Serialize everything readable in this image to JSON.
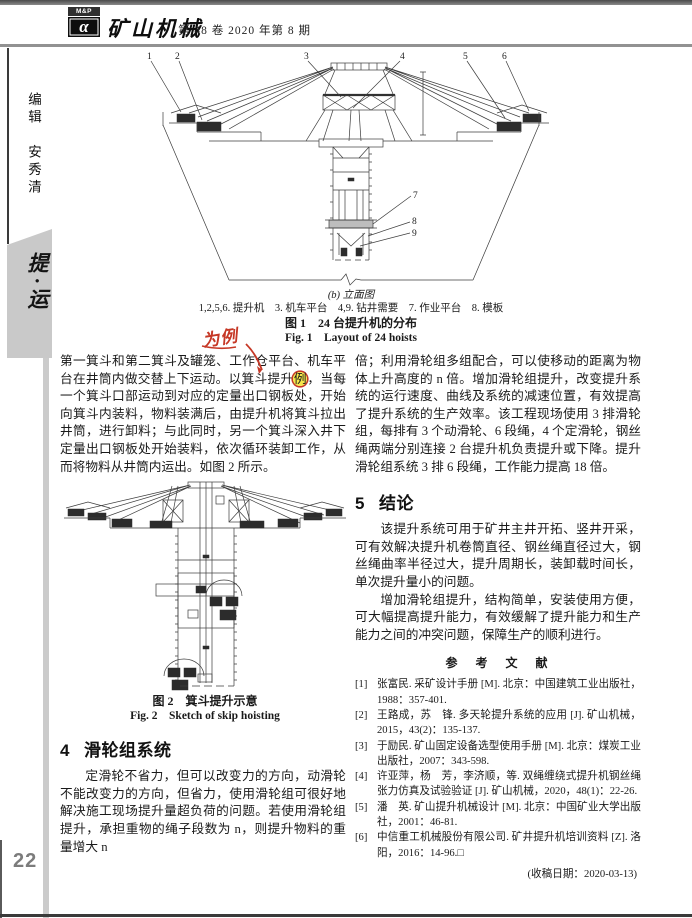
{
  "header": {
    "logo_top": "M&P",
    "logo_alpha": "α",
    "journal_name": "矿山机械",
    "issue_info": "第 48 卷 2020 年第 8 期"
  },
  "sidebar": {
    "editor": "编辑　安秀清",
    "section_tab": "提·运",
    "page_number": "22"
  },
  "figure1": {
    "sublabel": "(b) 立面图",
    "legend": "1,2,5,6. 提升机　3. 机车平台　4,9. 钻井需要　7. 作业平台　8. 模板",
    "caption_zh": "图 1　24 台提升机的分布",
    "caption_en": "Fig. 1　Layout of 24 hoists",
    "callouts": [
      "1",
      "2",
      "3",
      "4",
      "5",
      "6",
      "7",
      "8",
      "9"
    ]
  },
  "annotation": {
    "handwriting": "为例",
    "ink_color": "#c63826",
    "highlight_color": "#f6e64a"
  },
  "left_column": {
    "para1_before": "第一箕斗和第二箕斗及罐笼、工作仓平台、机车平台在井筒内做交替上下运动。以箕斗提升",
    "para1_mark": "例",
    "para1_after": "，当每一个箕斗口部运动到对应的定量出口钢板处，开始向箕斗内装料，物料装满后，由提升机将箕斗拉出井筒，进行卸料；与此同时，另一个箕斗深入井下定量出口钢板处开始装料，依次循环装卸工作，从而将物料从井筒内运出。如图 2 所示。",
    "figure2": {
      "caption_zh": "图 2　箕斗提升示意",
      "caption_en": "Fig. 2　Sketch of skip hoisting"
    },
    "section4_no": "4",
    "section4_title": "滑轮组系统",
    "section4_para": "定滑轮不省力，但可以改变力的方向，动滑轮不能改变力的方向，但省力，使用滑轮组可很好地解决施工现场提升量超负荷的问题。若使用滑轮组提升，承担重物的绳子段数为 n，则提升物料的重量增大 n"
  },
  "right_column": {
    "para_top": "倍；利用滑轮组多组配合，可以使移动的距离为物体上升高度的 n 倍。增加滑轮组提升，改变提升系统的运行速度、曲线及系统的减速位置，有效提高了提升系统的生产效率。该工程现场使用 3 排滑轮组，每排有 3 个动滑轮、6 段绳，4 个定滑轮，钢丝绳两端分别连接 2 台提升机负责提升或下降。提升滑轮组系统 3 排 6 段绳，工作能力提高 18 倍。",
    "section5_no": "5",
    "section5_title": "结论",
    "section5_para1": "该提升系统可用于矿井主井开拓、竖井开采，可有效解决提升机卷筒直径、钢丝绳直径过大，钢丝绳曲率半径过大，提升周期长，装卸载时间长，单次提升量小的问题。",
    "section5_para2": "增加滑轮组提升，结构简单，安装使用方便，可大幅提高提升能力，有效缓解了提升能力和生产能力之间的冲突问题，保障生产的顺利进行。",
    "references_title": "参　考　文　献",
    "references": [
      {
        "no": "[1]",
        "text": "张富民. 采矿设计手册 [M]. 北京：中国建筑工业出版社，1988：357-401."
      },
      {
        "no": "[2]",
        "text": "王路成，苏　锋. 多天轮提升系统的应用 [J]. 矿山机械，2015，43(2)：135-137."
      },
      {
        "no": "[3]",
        "text": "于励民. 矿山固定设备选型使用手册 [M]. 北京：煤炭工业出版社，2007：343-598."
      },
      {
        "no": "[4]",
        "text": "许亚萍，杨　芳，李济顺，等. 双绳缠绕式提升机钢丝绳张力仿真及试验验证 [J]. 矿山机械，2020，48(1)：22-26."
      },
      {
        "no": "[5]",
        "text": "潘　英. 矿山提升机械设计 [M]. 北京：中国矿业大学出版社，2001：46-81."
      },
      {
        "no": "[6]",
        "text": "中信重工机械股份有限公司. 矿井提升机培训资料 [Z]. 洛阳，2016：14-96.□"
      }
    ],
    "received_date": "(收稿日期：2020-03-13)"
  }
}
